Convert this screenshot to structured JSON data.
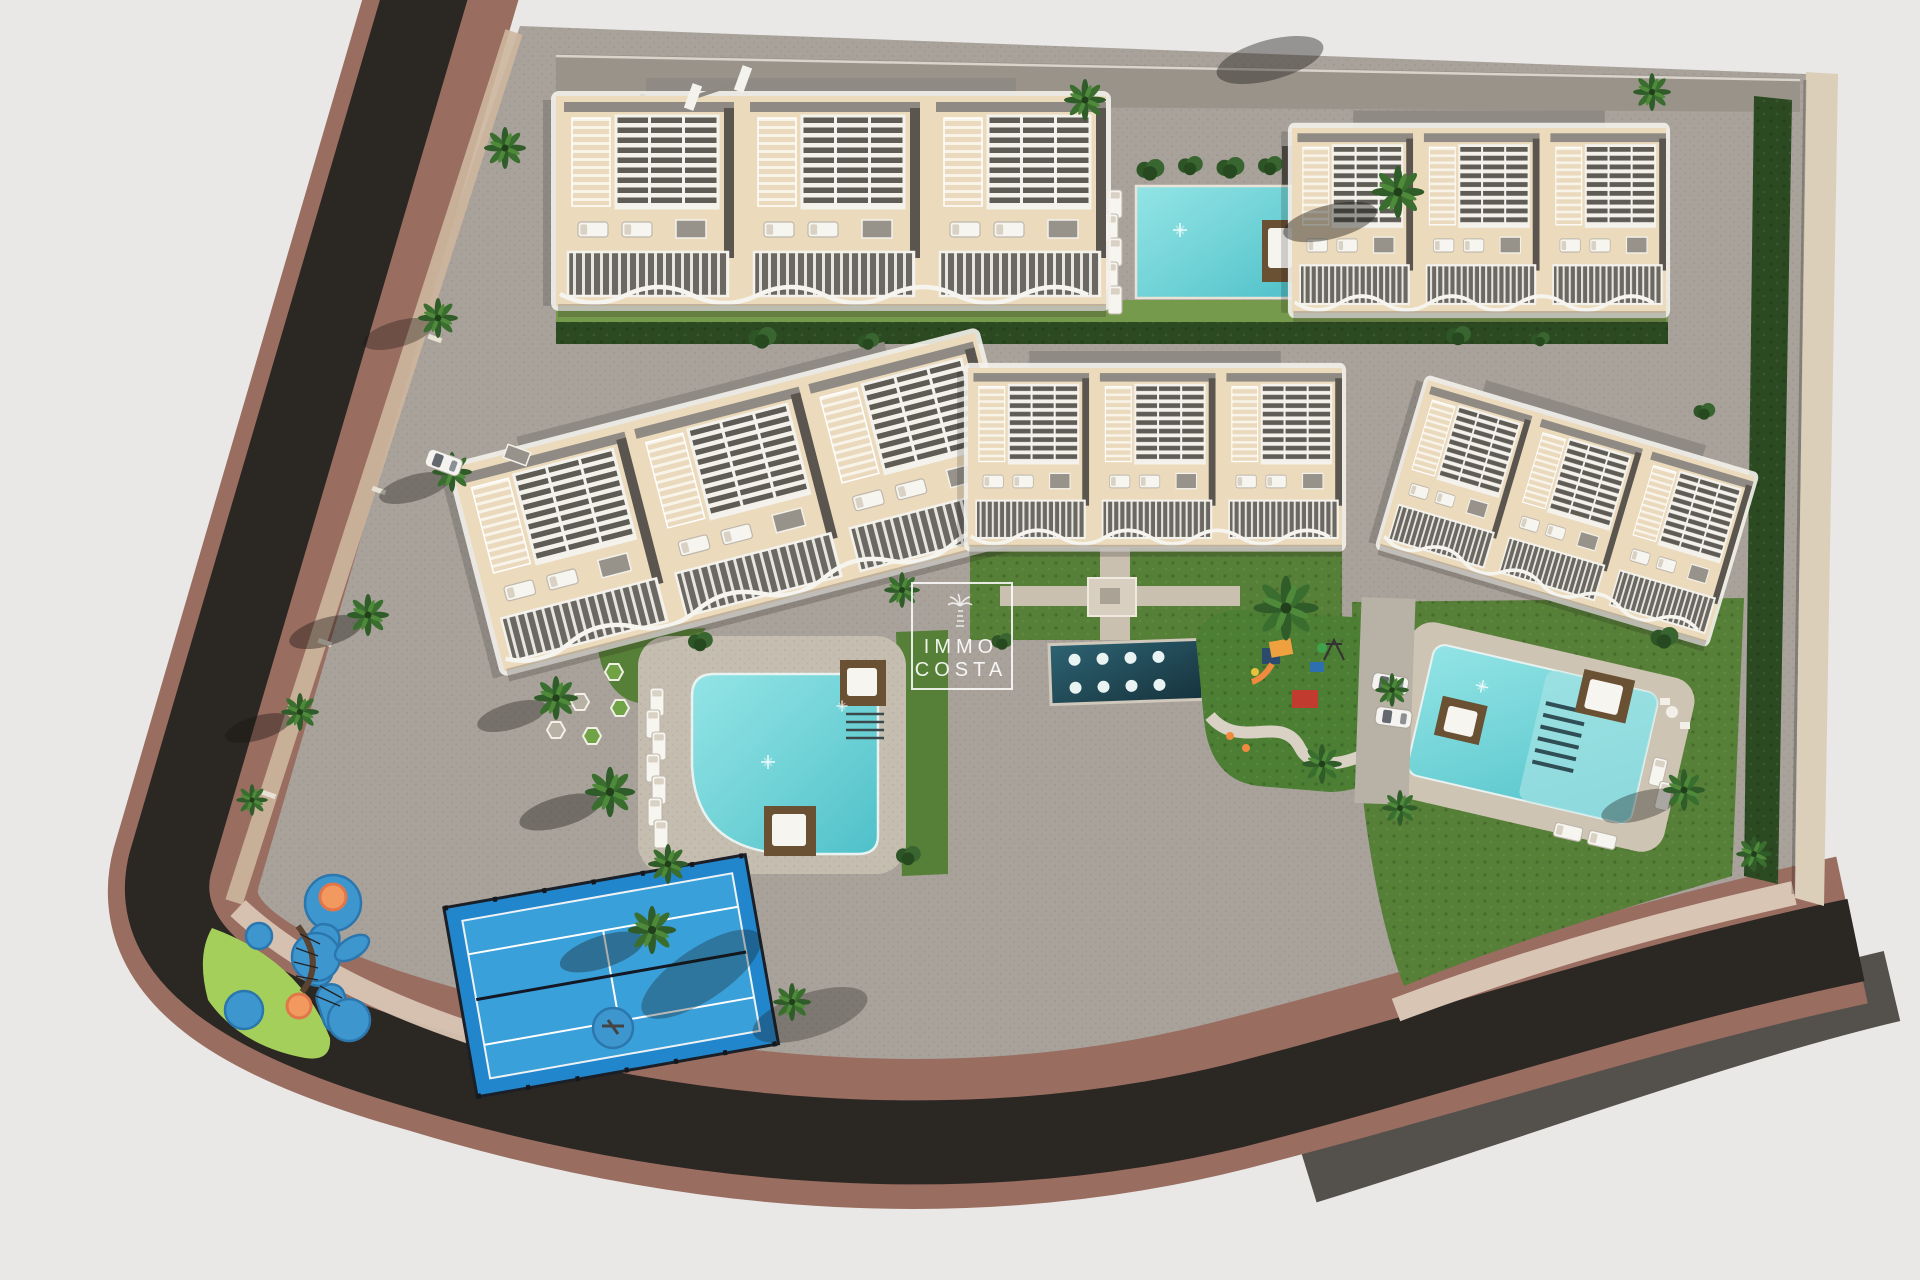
{
  "scene": {
    "watermark": {
      "line1": "IMMO",
      "line2": "COSTA"
    },
    "colors": {
      "bg": "#e9e8e6",
      "road": "#2b2722",
      "sidewalk": "#9a6d61",
      "sidewalk_light": "#d9c5b4",
      "curb": "#cdb69e",
      "pave": "#a8a29a",
      "pave_dark": "#999389",
      "grass": "#567f37",
      "grass_bright": "#a4cf5b",
      "hedge": "#2c4a22",
      "roof": "#ecdabc",
      "trim": "#f4f2ec",
      "gray": "#6b6861",
      "pool": "#6fd2d6",
      "pool_deep": "#4fc0c9",
      "wfeature": "#1e4854",
      "deck": "#6b5134",
      "court": "#2186cc",
      "court_light": "#3aa0da",
      "play_blue": "#3e96cf",
      "play_orange": "#f2995f",
      "play_red": "#c23b2f"
    }
  }
}
